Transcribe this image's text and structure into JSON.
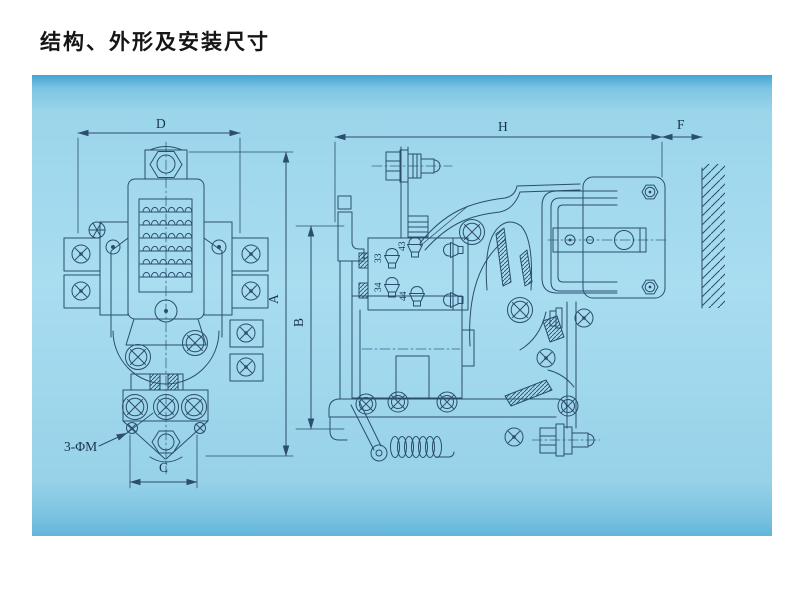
{
  "page": {
    "title": "结构、外形及安装尺寸",
    "background": "#ffffff"
  },
  "panel": {
    "fill_top": "#43a6d4",
    "fill_mid": "#a9ddf0",
    "fill_bottom": "#60b6da",
    "line_color": "#2b4d6e"
  },
  "front_view": {
    "label": "front-outline-view",
    "dims": {
      "width_top": "D",
      "height": "A",
      "width_bottom": "C"
    },
    "annotation_mounting": "3-ΦM"
  },
  "side_view": {
    "label": "side-installation-view",
    "dims": {
      "width": "H",
      "wall_gap": "F",
      "height": "B"
    },
    "terminals": {
      "t43": "43",
      "t33": "33",
      "t34": "34",
      "t44": "44"
    }
  }
}
